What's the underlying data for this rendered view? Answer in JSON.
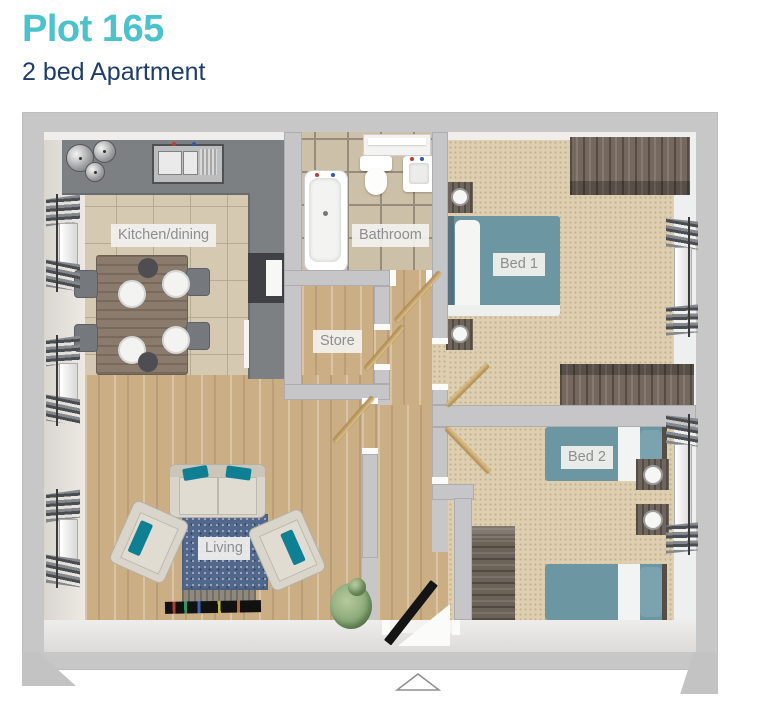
{
  "header": {
    "plot_title": "Plot 165",
    "subtitle": "2 bed Apartment"
  },
  "floorplan": {
    "rooms": [
      {
        "id": "kitchen-dining",
        "label": "Kitchen/dining"
      },
      {
        "id": "bathroom",
        "label": "Bathroom"
      },
      {
        "id": "store",
        "label": "Store"
      },
      {
        "id": "bed1",
        "label": "Bed 1"
      },
      {
        "id": "bed2",
        "label": "Bed 2"
      },
      {
        "id": "living",
        "label": "Living"
      }
    ],
    "entrance_marker": "triangle-up-arrow"
  },
  "colors": {
    "accent_teal": "#4CC2CC",
    "navy": "#1D3D6B",
    "wall_outer": "#C7C7C8",
    "wall_inner_face": "#EDEAE5",
    "interior_wall": "#C6C6C8",
    "kitchen_counter": "#7D8083",
    "kitchen_tile": "#D6C9B1",
    "bathroom_tile": "#CDC0A9",
    "wood_floor": "#CCAE85",
    "carpet": "#DDCFB0",
    "bed_teal": "#6D96A3",
    "rug_blue": "#51688C",
    "sofa_cream": "#D9D5CA",
    "cushion_teal": "#0F7F93",
    "furniture_dark_wood": "#75695F",
    "door_gold": "#C8A469",
    "entrance_door_black": "#141414"
  }
}
